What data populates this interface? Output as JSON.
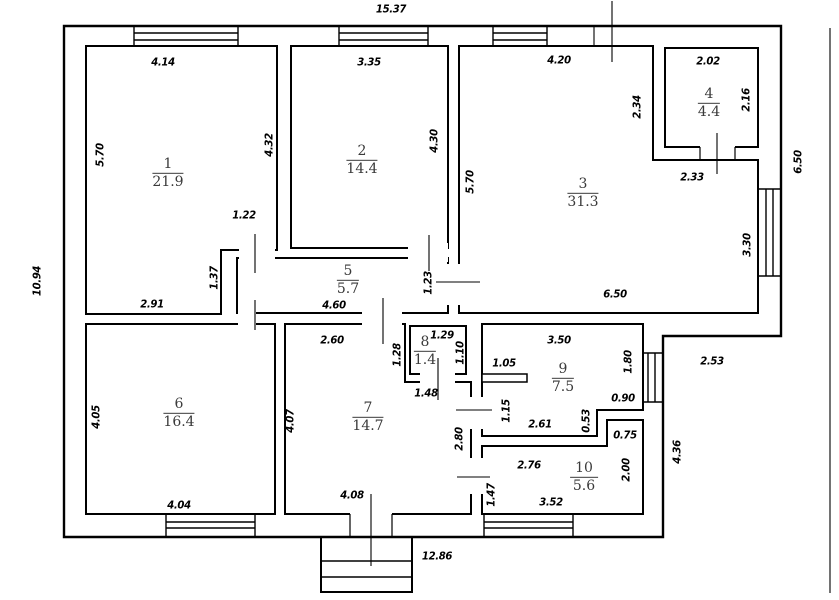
{
  "plan": {
    "type": "apartment-floor-plan",
    "line_color": "#000000",
    "background": "#ffffff",
    "rooms": [
      {
        "number": "1",
        "area": "21.9"
      },
      {
        "number": "2",
        "area": "14.4"
      },
      {
        "number": "3",
        "area": "31.3"
      },
      {
        "number": "4",
        "area": "4.4"
      },
      {
        "number": "5",
        "area": "5.7"
      },
      {
        "number": "6",
        "area": "16.4"
      },
      {
        "number": "7",
        "area": "14.7"
      },
      {
        "number": "8",
        "area": "1.4"
      },
      {
        "number": "9",
        "area": "7.5"
      },
      {
        "number": "10",
        "area": "5.6"
      }
    ],
    "dims_h": [
      "15.37",
      "4.14",
      "3.35",
      "4.20",
      "2.02",
      "1.22",
      "2.91",
      "4.60",
      "6.50",
      "2.33",
      "2.60",
      "1.29",
      "3.50",
      "1.05",
      "1.48",
      "2.61",
      "0.90",
      "0.75",
      "2.76",
      "3.52",
      "4.04",
      "4.08",
      "2.53",
      "12.86"
    ],
    "dims_v": [
      "10.94",
      "5.70",
      "4.32",
      "4.30",
      "5.70",
      "2.34",
      "2.16",
      "6.50",
      "3.30",
      "1.37",
      "1.23",
      "1.28",
      "1.10",
      "1.80",
      "1.15",
      "0.53",
      "2.80",
      "2.00",
      "1.47",
      "4.05",
      "4.07",
      "4.36"
    ]
  }
}
